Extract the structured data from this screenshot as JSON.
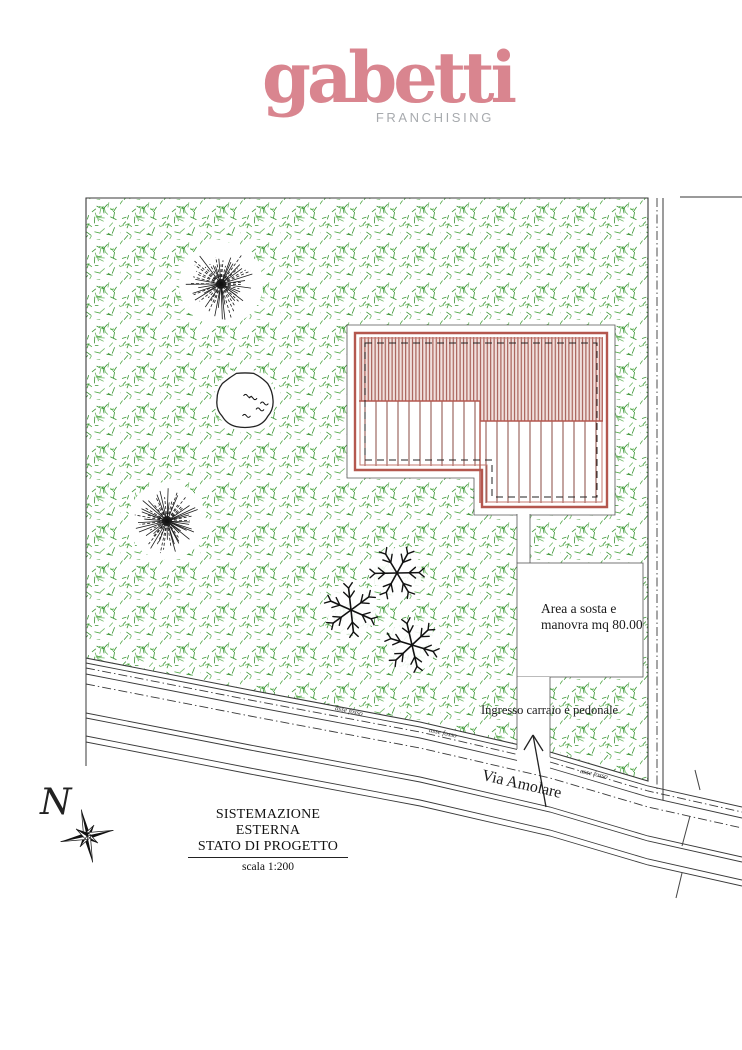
{
  "logo": {
    "brand": "gabetti",
    "subtitle": "FRANCHISING",
    "brand_color": "#d9858f",
    "subtitle_color": "#a7aaae"
  },
  "plan": {
    "labels": {
      "parking_line1": "Area a sosta e",
      "parking_line2": "manovra mq 80.00",
      "entrance": "Ingresso carraio e pedonale",
      "street": "Via Amolare",
      "ditch_axis": "asse fosso",
      "north": "N"
    },
    "colors": {
      "vegetation1": "#44a23a",
      "vegetation2": "#2f8f28",
      "vegetation3": "#63b159",
      "roof_hatch": "#a2564e",
      "roof_bg": "#f1e0dd",
      "roof_sparse": "#8a4a42",
      "building_outline": "#b4574e",
      "building_inner": "#c5786f",
      "drawing_line": "#3a3a3a",
      "ink": "#1a1a1a"
    }
  },
  "title_block": {
    "line1": "SISTEMAZIONE ESTERNA",
    "line2": "STATO DI PROGETTO",
    "scale": "scala 1:200"
  }
}
